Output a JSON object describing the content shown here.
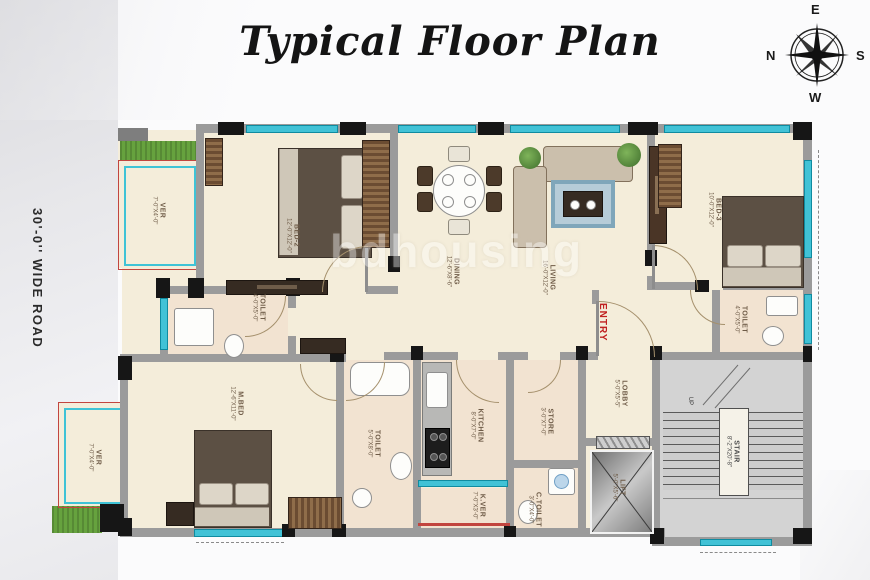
{
  "title": "Typical Floor Plan",
  "watermark": "bdhousing",
  "road_label": "30'-0'' WIDE ROAD",
  "entry_label": "ENTRY",
  "up_label": "UP",
  "compass": {
    "top": "E",
    "left": "N",
    "right": "S",
    "bottom": "W"
  },
  "rooms": {
    "ver_top": {
      "name": "VER",
      "dims": "7'-0\"X4'-0\""
    },
    "bed2": {
      "name": "BED-2",
      "dims": "12'-0\"X12'-0\""
    },
    "dining": {
      "name": "DINING",
      "dims": "12'-6\"X8'-6\""
    },
    "living": {
      "name": "LIVING",
      "dims": "16'-0\"X12'-0\""
    },
    "bed3": {
      "name": "BED-3",
      "dims": "10'-0\"X12'-0\""
    },
    "toilet_bed2": {
      "name": "TOILET",
      "dims": "4'-0\"X5'-0\""
    },
    "toilet_bed3": {
      "name": "TOILET",
      "dims": "4'-0\"X5'-0\""
    },
    "mbed": {
      "name": "M.BED",
      "dims": "12'-6\"X11'-0\""
    },
    "ver_bottom": {
      "name": "VER",
      "dims": "7'-0\"X4'-0\""
    },
    "toilet_m": {
      "name": "TOILET",
      "dims": "5'-0\"X8'-0\""
    },
    "kitchen": {
      "name": "KITCHEN",
      "dims": "8'-0\"X7'-0\""
    },
    "store": {
      "name": "STORE",
      "dims": "3'-0\"X7'-0\""
    },
    "kver": {
      "name": "K.VER",
      "dims": "7'-0\"X3'-0\""
    },
    "ctoilet": {
      "name": "C.TOILET",
      "dims": "3'-0\"X4'-0\""
    },
    "lobby": {
      "name": "LOBBY",
      "dims": "5'-0\"X5'-5\""
    },
    "lift": {
      "name": "LIFT",
      "dims": "5'-0\"X5'-6\""
    },
    "stair": {
      "name": "STAIR",
      "dims": "8'-2\"X20'-8\""
    }
  },
  "colors": {
    "window_cyan": "#41c2d6",
    "wall_gray": "#9b9b9b",
    "floor_cream": "#f4edda",
    "grass_green": "#66a23e",
    "entry_red": "#c02020",
    "frame_red": "#c2453f"
  }
}
